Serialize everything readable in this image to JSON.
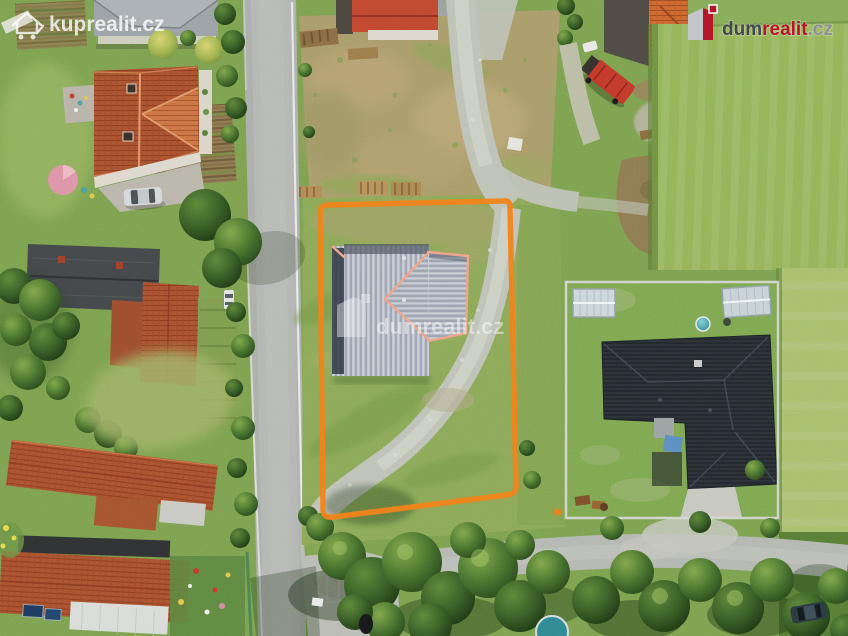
{
  "watermarks": {
    "top_left": {
      "text": "kuprealit.cz"
    },
    "top_right": {
      "dum": "dum",
      "realit": "realit",
      "cz": ".cz"
    },
    "center": {
      "dum": "dum",
      "realit": "realit",
      "cz": ".cz"
    }
  },
  "colors": {
    "plot_outline": "#f07d1a",
    "brand_red": "#b5172a",
    "brand_dark": "#43484e",
    "brand_gray": "#8d9298",
    "watermark_white": "#ffffff",
    "road_asphalt": "#b3b5b2",
    "gravel_path": "#bdc1b6",
    "barn_roof": "#b4bac4",
    "grass": "#7ba04f"
  }
}
